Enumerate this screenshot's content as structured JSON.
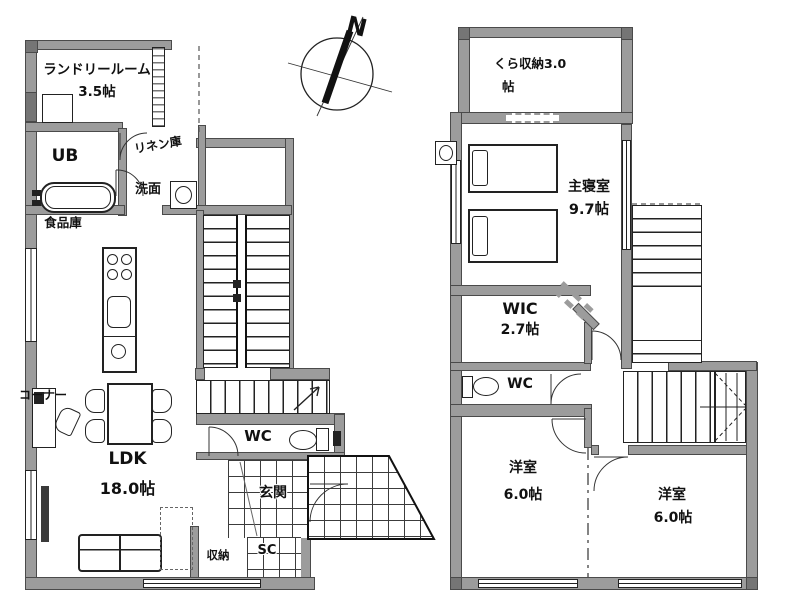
{
  "compass": {
    "north_label": "N"
  },
  "floor1": {
    "rooms": {
      "laundry": {
        "name": "ランドリールーム",
        "size": "3.5帖"
      },
      "bath": {
        "name": "UB"
      },
      "linen": {
        "name": "リネン庫"
      },
      "washroom": {
        "name": "洗面"
      },
      "pantry": {
        "name": "食品庫"
      },
      "corner": {
        "name": "コーナー"
      },
      "ldk": {
        "name": "LDK",
        "size": "18.0帖"
      },
      "toilet": {
        "name": "WC"
      },
      "entrance": {
        "name": "玄関"
      },
      "storage": {
        "name": "収納"
      },
      "shoe_closet": {
        "name": "SC"
      }
    }
  },
  "floor2": {
    "rooms": {
      "kura_storage": {
        "name": "くら収納3.0",
        "size": "帖"
      },
      "master_bedroom": {
        "name": "主寝室",
        "size": "9.7帖"
      },
      "wic": {
        "name": "WIC",
        "size": "2.7帖"
      },
      "toilet": {
        "name": "WC"
      },
      "bedroom_a": {
        "name": "洋室",
        "size": "6.0帖"
      },
      "bedroom_b": {
        "name": "洋室",
        "size": "6.0帖"
      }
    }
  },
  "colors": {
    "wall": "#9c9c9c",
    "line": "#222222",
    "background": "#ffffff"
  }
}
